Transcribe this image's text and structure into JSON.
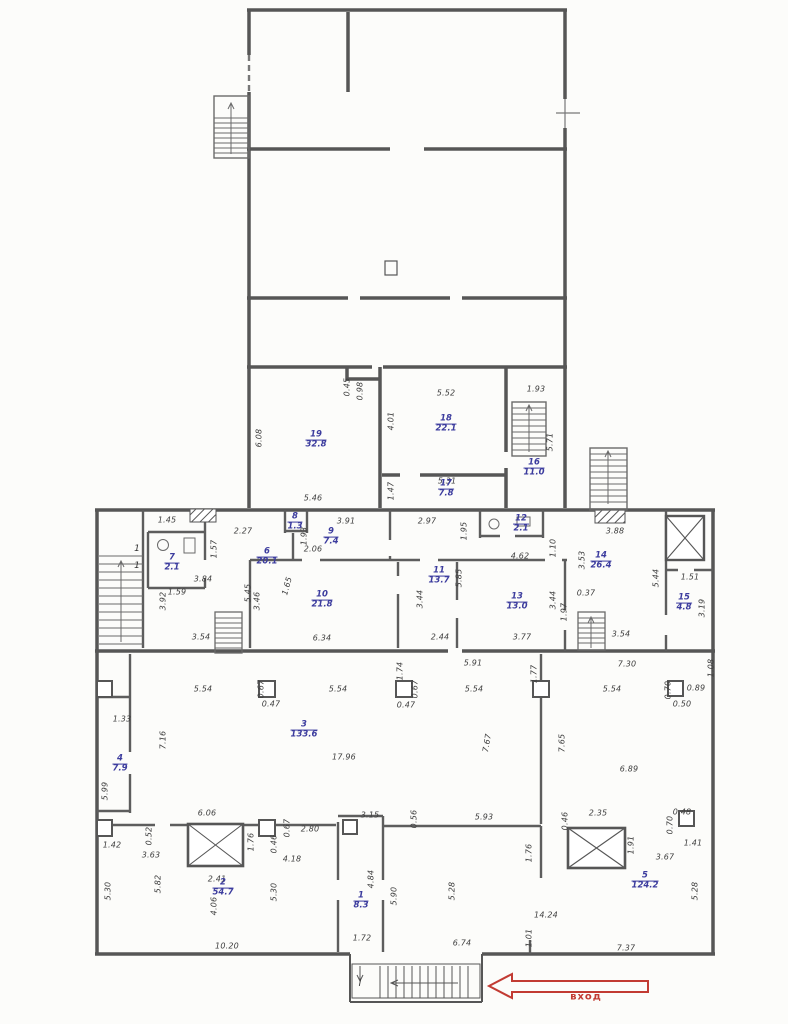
{
  "colors": {
    "dimension": "#3d3d3d",
    "room_label": "#3c3c9e",
    "entrance": "#c23b33",
    "walls": "#565656"
  },
  "entrance": {
    "label": "вход"
  },
  "stair_marks": [
    {
      "t": "1",
      "x": 137,
      "y": 549
    },
    {
      "t": "1",
      "x": 137,
      "y": 566
    },
    {
      "t": "I",
      "x": 360,
      "y": 984
    }
  ],
  "rooms": [
    {
      "num": "1",
      "area": "8.3",
      "x": 361,
      "y": 901
    },
    {
      "num": "2",
      "area": "54.7",
      "x": 223,
      "y": 888
    },
    {
      "num": "3",
      "area": "133.6",
      "x": 304,
      "y": 730
    },
    {
      "num": "4",
      "area": "7.9",
      "x": 120,
      "y": 764
    },
    {
      "num": "5",
      "area": "124.2",
      "x": 645,
      "y": 881
    },
    {
      "num": "6",
      "area": "20.1",
      "x": 267,
      "y": 557
    },
    {
      "num": "7",
      "area": "2.1",
      "x": 172,
      "y": 563
    },
    {
      "num": "8",
      "area": "1.3",
      "x": 295,
      "y": 522
    },
    {
      "num": "9",
      "area": "7.4",
      "x": 331,
      "y": 537
    },
    {
      "num": "10",
      "area": "21.8",
      "x": 322,
      "y": 600
    },
    {
      "num": "11",
      "area": "13.7",
      "x": 439,
      "y": 576
    },
    {
      "num": "12",
      "area": "2.1",
      "x": 521,
      "y": 524
    },
    {
      "num": "13",
      "area": "13.0",
      "x": 517,
      "y": 602
    },
    {
      "num": "14",
      "area": "26.4",
      "x": 601,
      "y": 561
    },
    {
      "num": "15",
      "area": "4.8",
      "x": 684,
      "y": 603
    },
    {
      "num": "16",
      "area": "11.0",
      "x": 534,
      "y": 468
    },
    {
      "num": "17",
      "area": "7.8",
      "x": 446,
      "y": 489
    },
    {
      "num": "18",
      "area": "22.1",
      "x": 446,
      "y": 424
    },
    {
      "num": "19",
      "area": "32.8",
      "x": 316,
      "y": 440
    }
  ],
  "dims": [
    {
      "t": "0.45",
      "x": 347,
      "y": 387,
      "r": -90
    },
    {
      "t": "0.98",
      "x": 360,
      "y": 391,
      "r": -90
    },
    {
      "t": "6.08",
      "x": 259,
      "y": 438,
      "r": -90
    },
    {
      "t": "5.46",
      "x": 313,
      "y": 498
    },
    {
      "t": "5.52",
      "x": 446,
      "y": 393
    },
    {
      "t": "4.01",
      "x": 391,
      "y": 421,
      "r": -90
    },
    {
      "t": "1.93",
      "x": 536,
      "y": 389
    },
    {
      "t": "5.71",
      "x": 550,
      "y": 442,
      "r": -90
    },
    {
      "t": "1.47",
      "x": 391,
      "y": 491,
      "r": -90
    },
    {
      "t": "5.31",
      "x": 447,
      "y": 481
    },
    {
      "t": "1.45",
      "x": 167,
      "y": 520
    },
    {
      "t": "2.27",
      "x": 243,
      "y": 531
    },
    {
      "t": "1.57",
      "x": 214,
      "y": 549,
      "r": -90
    },
    {
      "t": "1.59",
      "x": 177,
      "y": 592
    },
    {
      "t": "3.84",
      "x": 203,
      "y": 579
    },
    {
      "t": "5.45",
      "x": 248,
      "y": 593,
      "r": -90
    },
    {
      "t": "1.65",
      "x": 287,
      "y": 586,
      "r": -75
    },
    {
      "t": "3.92",
      "x": 163,
      "y": 601,
      "r": -90
    },
    {
      "t": "3.54",
      "x": 201,
      "y": 637
    },
    {
      "t": "3.91",
      "x": 346,
      "y": 521
    },
    {
      "t": "1.93",
      "x": 304,
      "y": 536,
      "r": -90
    },
    {
      "t": "2.06",
      "x": 313,
      "y": 549
    },
    {
      "t": "2.97",
      "x": 427,
      "y": 521
    },
    {
      "t": "1.95",
      "x": 464,
      "y": 531,
      "r": -90
    },
    {
      "t": "1.10",
      "x": 553,
      "y": 548,
      "r": -90
    },
    {
      "t": "4.62",
      "x": 520,
      "y": 556
    },
    {
      "t": "3.53",
      "x": 582,
      "y": 560,
      "r": -90
    },
    {
      "t": "3.88",
      "x": 615,
      "y": 531
    },
    {
      "t": "3.46",
      "x": 257,
      "y": 601,
      "r": -90
    },
    {
      "t": "6.34",
      "x": 322,
      "y": 638
    },
    {
      "t": "3.44",
      "x": 420,
      "y": 599,
      "r": -90
    },
    {
      "t": "5.85",
      "x": 459,
      "y": 578,
      "r": -90
    },
    {
      "t": "2.44",
      "x": 440,
      "y": 637
    },
    {
      "t": "3.44",
      "x": 553,
      "y": 600,
      "r": -90
    },
    {
      "t": "3.77",
      "x": 522,
      "y": 637
    },
    {
      "t": "0.37",
      "x": 586,
      "y": 593
    },
    {
      "t": "1.97",
      "x": 564,
      "y": 612,
      "r": -90
    },
    {
      "t": "5.44",
      "x": 656,
      "y": 578,
      "r": -90
    },
    {
      "t": "1.51",
      "x": 690,
      "y": 577
    },
    {
      "t": "3.19",
      "x": 702,
      "y": 608,
      "r": -90
    },
    {
      "t": "3.54",
      "x": 621,
      "y": 634
    },
    {
      "t": "5.91",
      "x": 473,
      "y": 663
    },
    {
      "t": "7.30",
      "x": 627,
      "y": 664
    },
    {
      "t": "1.08",
      "x": 711,
      "y": 668,
      "r": -90
    },
    {
      "t": "5.54",
      "x": 203,
      "y": 689
    },
    {
      "t": "0.67",
      "x": 261,
      "y": 689,
      "r": -90
    },
    {
      "t": "0.47",
      "x": 271,
      "y": 704
    },
    {
      "t": "5.54",
      "x": 338,
      "y": 689
    },
    {
      "t": "1.74",
      "x": 400,
      "y": 671,
      "r": -90
    },
    {
      "t": "0.67",
      "x": 415,
      "y": 689,
      "r": -90
    },
    {
      "t": "0.47",
      "x": 406,
      "y": 705
    },
    {
      "t": "5.54",
      "x": 474,
      "y": 689
    },
    {
      "t": "1.77",
      "x": 534,
      "y": 674,
      "r": -90
    },
    {
      "t": "5.54",
      "x": 612,
      "y": 689
    },
    {
      "t": "0.70",
      "x": 668,
      "y": 690,
      "r": -90
    },
    {
      "t": "0.89",
      "x": 696,
      "y": 688
    },
    {
      "t": "0.50",
      "x": 682,
      "y": 704
    },
    {
      "t": "1.33",
      "x": 122,
      "y": 719
    },
    {
      "t": "7.16",
      "x": 163,
      "y": 740,
      "r": -90
    },
    {
      "t": "17.96",
      "x": 344,
      "y": 757
    },
    {
      "t": "7.67",
      "x": 487,
      "y": 743,
      "r": -80
    },
    {
      "t": "7.65",
      "x": 562,
      "y": 743,
      "r": -90
    },
    {
      "t": "6.89",
      "x": 629,
      "y": 769
    },
    {
      "t": "5.99",
      "x": 105,
      "y": 791,
      "r": -90
    },
    {
      "t": "6.06",
      "x": 207,
      "y": 813
    },
    {
      "t": "5.93",
      "x": 484,
      "y": 817
    },
    {
      "t": "3.15",
      "x": 370,
      "y": 815
    },
    {
      "t": "0.56",
      "x": 414,
      "y": 819,
      "r": -90
    },
    {
      "t": "2.35",
      "x": 598,
      "y": 813
    },
    {
      "t": "0.46",
      "x": 565,
      "y": 821,
      "r": -90
    },
    {
      "t": "0.48",
      "x": 682,
      "y": 812
    },
    {
      "t": "0.70",
      "x": 670,
      "y": 825,
      "r": -90
    },
    {
      "t": "1.91",
      "x": 631,
      "y": 845,
      "r": -90
    },
    {
      "t": "3.67",
      "x": 665,
      "y": 857
    },
    {
      "t": "1.41",
      "x": 693,
      "y": 843
    },
    {
      "t": "1.76",
      "x": 529,
      "y": 853,
      "r": -90
    },
    {
      "t": "1.42",
      "x": 112,
      "y": 845
    },
    {
      "t": "0.52",
      "x": 149,
      "y": 836,
      "r": -90
    },
    {
      "t": "3.63",
      "x": 151,
      "y": 855
    },
    {
      "t": "0.67",
      "x": 287,
      "y": 828,
      "r": -90
    },
    {
      "t": "2.80",
      "x": 310,
      "y": 829
    },
    {
      "t": "1.76",
      "x": 251,
      "y": 842,
      "r": -90
    },
    {
      "t": "0.46",
      "x": 274,
      "y": 844,
      "r": -90
    },
    {
      "t": "4.18",
      "x": 292,
      "y": 859
    },
    {
      "t": "2.41",
      "x": 217,
      "y": 879
    },
    {
      "t": "5.30",
      "x": 108,
      "y": 891,
      "r": -90
    },
    {
      "t": "5.82",
      "x": 158,
      "y": 884,
      "r": -90
    },
    {
      "t": "4.06",
      "x": 214,
      "y": 906,
      "r": -90
    },
    {
      "t": "5.30",
      "x": 274,
      "y": 892,
      "r": -90
    },
    {
      "t": "4.84",
      "x": 371,
      "y": 879,
      "r": -90
    },
    {
      "t": "5.90",
      "x": 394,
      "y": 896,
      "r": -90
    },
    {
      "t": "5.28",
      "x": 452,
      "y": 891,
      "r": -90
    },
    {
      "t": "5.28",
      "x": 695,
      "y": 891,
      "r": -90
    },
    {
      "t": "14.24",
      "x": 546,
      "y": 915
    },
    {
      "t": "1.72",
      "x": 362,
      "y": 938
    },
    {
      "t": "10.20",
      "x": 227,
      "y": 946
    },
    {
      "t": "6.74",
      "x": 462,
      "y": 943
    },
    {
      "t": "1.01",
      "x": 529,
      "y": 938,
      "r": -90
    },
    {
      "t": "7.37",
      "x": 626,
      "y": 948
    }
  ]
}
